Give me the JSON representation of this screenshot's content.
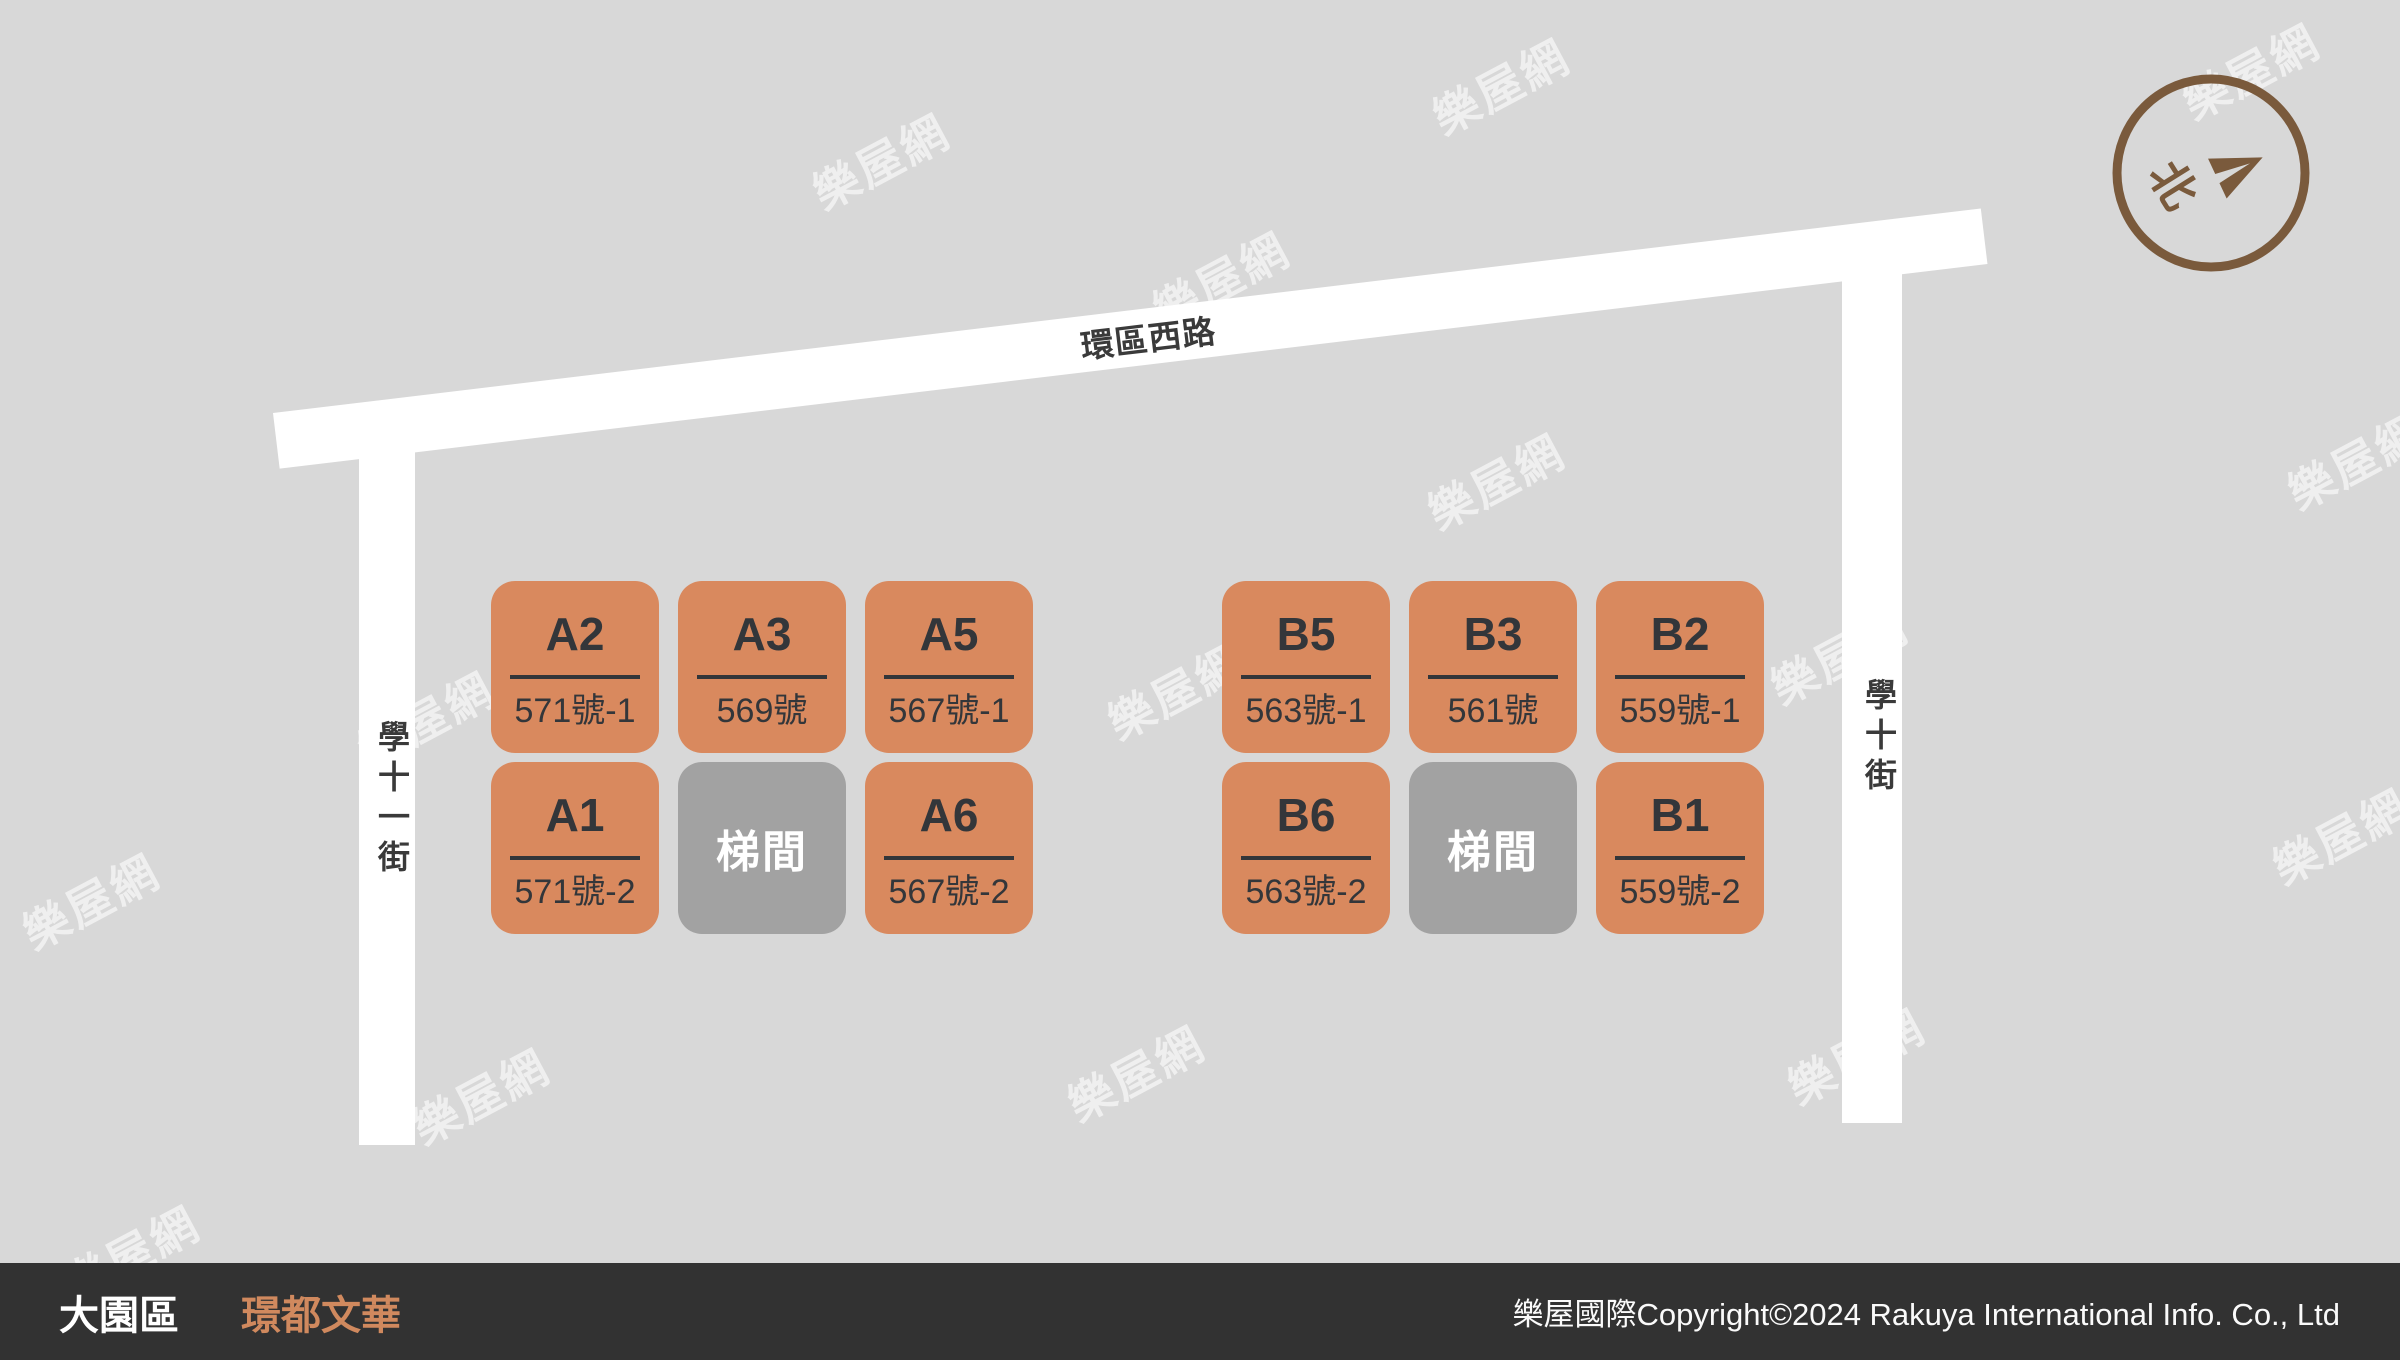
{
  "watermark": {
    "text": "樂屋網"
  },
  "roads": {
    "top": {
      "label": "環區西路"
    },
    "left": {
      "label": "學十一街"
    },
    "right": {
      "label": "學十街"
    }
  },
  "blocks": [
    {
      "id": "A",
      "units": [
        {
          "type": "unit",
          "label": "A2",
          "address": "571號-1"
        },
        {
          "type": "unit",
          "label": "A3",
          "address": "569號"
        },
        {
          "type": "unit",
          "label": "A5",
          "address": "567號-1"
        },
        {
          "type": "unit",
          "label": "A1",
          "address": "571號-2"
        },
        {
          "type": "stairwell",
          "label": "梯間"
        },
        {
          "type": "unit",
          "label": "A6",
          "address": "567號-2"
        }
      ]
    },
    {
      "id": "B",
      "units": [
        {
          "type": "unit",
          "label": "B5",
          "address": "563號-1"
        },
        {
          "type": "unit",
          "label": "B3",
          "address": "561號"
        },
        {
          "type": "unit",
          "label": "B2",
          "address": "559號-1"
        },
        {
          "type": "unit",
          "label": "B6",
          "address": "563號-2"
        },
        {
          "type": "stairwell",
          "label": "梯間"
        },
        {
          "type": "unit",
          "label": "B1",
          "address": "559號-2"
        }
      ]
    }
  ],
  "compass": {
    "north_label": "北"
  },
  "footer": {
    "district": "大園區",
    "project": "璟都文華",
    "copyright": "樂屋國際Copyright©2024 Rakuya International Info. Co., Ltd"
  },
  "colors": {
    "background": "#d8d8d8",
    "road": "#ffffff",
    "unit": "#d9895e",
    "stairwell": "#a2a2a2",
    "text_dark": "#33363a",
    "road_text": "#3a3a3a",
    "footer_bg": "#323232",
    "accent_orange": "#d0895e",
    "compass_brown": "#7a5a3c"
  }
}
